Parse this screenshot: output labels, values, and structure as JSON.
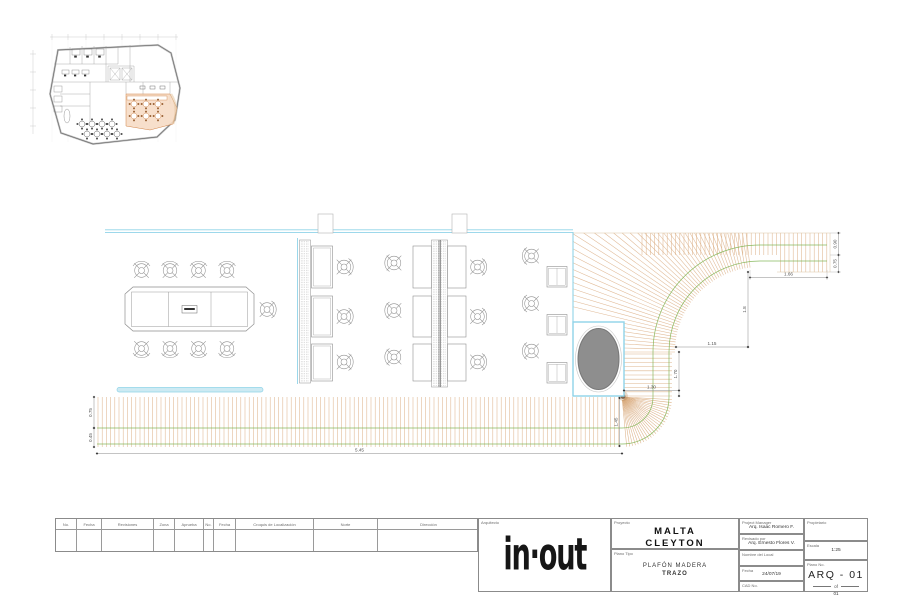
{
  "colors": {
    "wood": "#d8a87a",
    "green": "#7cb34f",
    "cyan": "#8fd3e8",
    "cyan_fill": "#cdeaf3",
    "furniture": "#8f8f8f",
    "oval_fill": "#8e8e8e",
    "peach_fill": "#f6d9c2",
    "peach_stroke": "#d08347",
    "dim_line": "#8a8a8a",
    "dim_text": "#555555"
  },
  "logo": {
    "text": "in·out"
  },
  "revision_table": {
    "headers": [
      "No.",
      "Fecha",
      "Revisiones",
      "Zona",
      "Aprueba",
      "No.",
      "Fecha",
      "Croquis de Localización",
      "Norte",
      "Dirección"
    ]
  },
  "title_block": {
    "architect_label": "Arquitecto",
    "project_label": "Proyecto",
    "project_name_line1": "MALTA",
    "project_name_line2": "CLEYTON",
    "plan_type_label": "Plano Tipo",
    "plan_type_line1": "PLAFÓN MADERA",
    "plan_type_line2": "TRAZO",
    "project_manager_label": "Project Manager",
    "project_manager": "Arq. Isaac Romero F.",
    "reviewed_label": "Revisado por",
    "reviewed_by": "Arq. Ernesto Flores V.",
    "site_label": "Nombre del Local",
    "site": "",
    "date_label": "Fecha",
    "date": "24/07/19",
    "cad_label": "CAD No.",
    "cad": "",
    "owner_label": "Propietario",
    "owner": "",
    "scale_label": "Escala",
    "scale": "1:25",
    "sheet_label": "Plano No.",
    "sheet_number": "ARQ - 01",
    "sheet_of": "of",
    "sheet_total": "01"
  },
  "dimensions": {
    "top_right_width": "1.66",
    "right_upper": "0.90",
    "right_lower": "0.75",
    "curve_vertical": "1.8",
    "curve_horizontal": "1.15",
    "inner_vertical": "1.70",
    "box_width": "1.30",
    "band_inner": "1.45",
    "band_left_upper": "0.75",
    "band_left_lower": "0.45",
    "band_length": "5.45"
  }
}
